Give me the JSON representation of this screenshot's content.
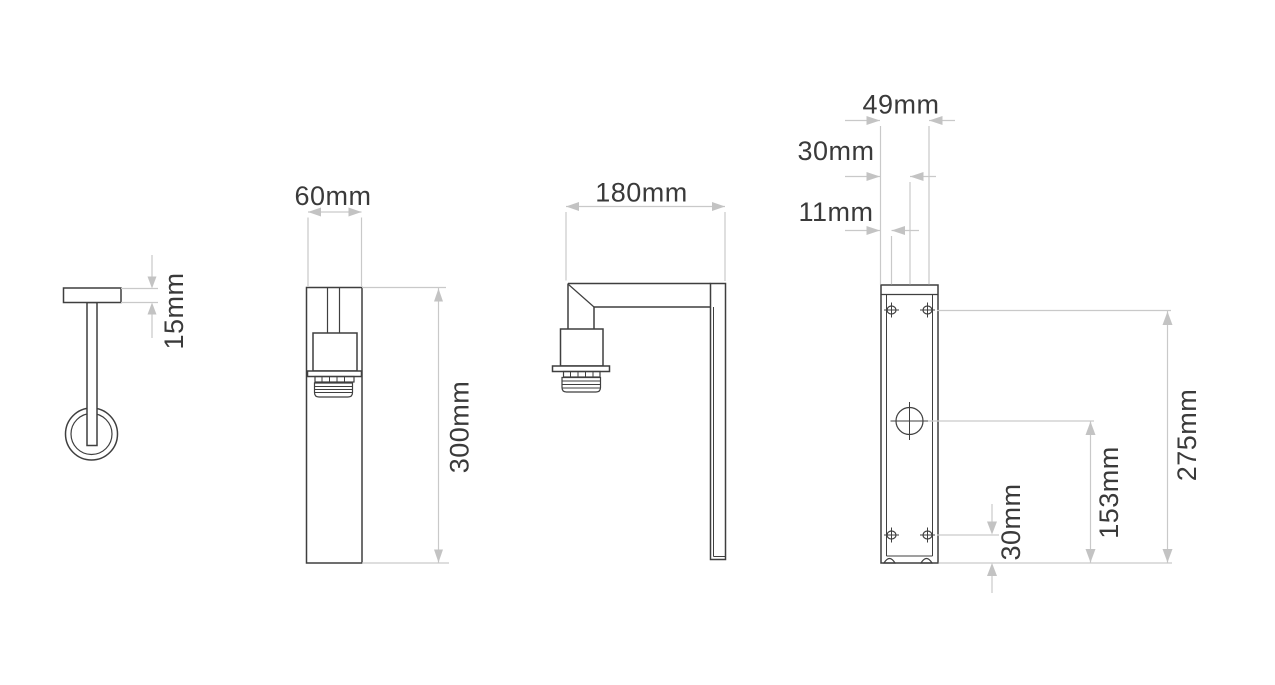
{
  "document": {
    "type": "technical-dimension-drawing",
    "subject": "wall-light-fixture",
    "views": {
      "top_view": "top view with mounting rose",
      "front_view": "front view with lamp holder",
      "side_view": "side view with right-angle arm",
      "rear_view": "rear view of backplate with fixing holes"
    }
  },
  "dims": {
    "d15": {
      "label": "15mm"
    },
    "d60": {
      "label": "60mm"
    },
    "d300": {
      "label": "300mm"
    },
    "d180": {
      "label": "180mm"
    },
    "d49": {
      "label": "49mm"
    },
    "d30t": {
      "label": "30mm"
    },
    "d11": {
      "label": "11mm"
    },
    "d275": {
      "label": "275mm"
    },
    "d153": {
      "label": "153mm"
    },
    "d30b": {
      "label": "30mm"
    }
  },
  "colors": {
    "bg": "#ffffff",
    "outline": "#3f3f3f",
    "outline2": "#5a5a5a",
    "dim": "#c9c9c9",
    "arrow": "#c3c3c3",
    "text": "#3a3a3a"
  }
}
